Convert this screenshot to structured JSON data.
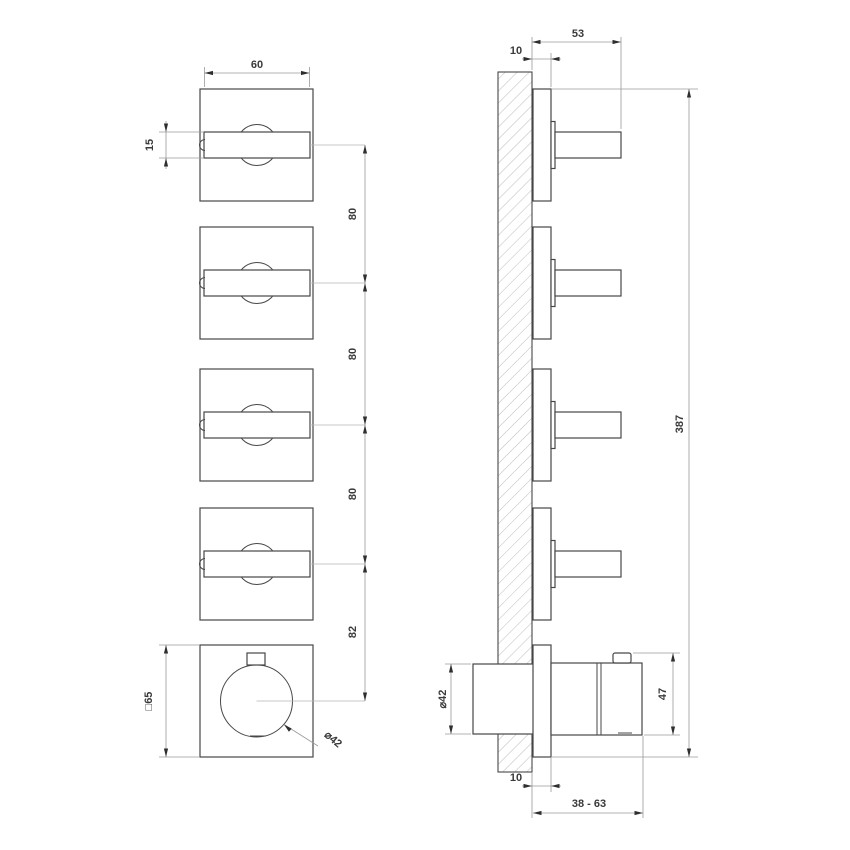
{
  "drawing": {
    "type": "technical-installation-drawing",
    "subject": "wall-mounted thermostatic mixer with 4 lever valves, front and side elevation",
    "views": {
      "front_label": "front elevation",
      "side_label": "side elevation with wall section"
    },
    "dimensions": {
      "front": {
        "handle_length": "60",
        "handle_width": "15",
        "spacing_1": "80",
        "spacing_2": "80",
        "spacing_3": "80",
        "spacing_thermostat": "82",
        "plate_size": "□65",
        "knob_diameter": "⌀42"
      },
      "side": {
        "wall_to_plate_top": "10",
        "handle_projection": "53",
        "overall_length": "387",
        "knob_height": "47",
        "valve_body_diameter": "⌀42",
        "wall_to_plate_bottom": "10",
        "installation_depth_range": "38 - 63"
      }
    },
    "colors": {
      "line": "#474747",
      "dimension_line": "#9a9a9a",
      "text": "#3a3a3a",
      "hatch": "#bcbcbc",
      "background": "#ffffff"
    }
  }
}
